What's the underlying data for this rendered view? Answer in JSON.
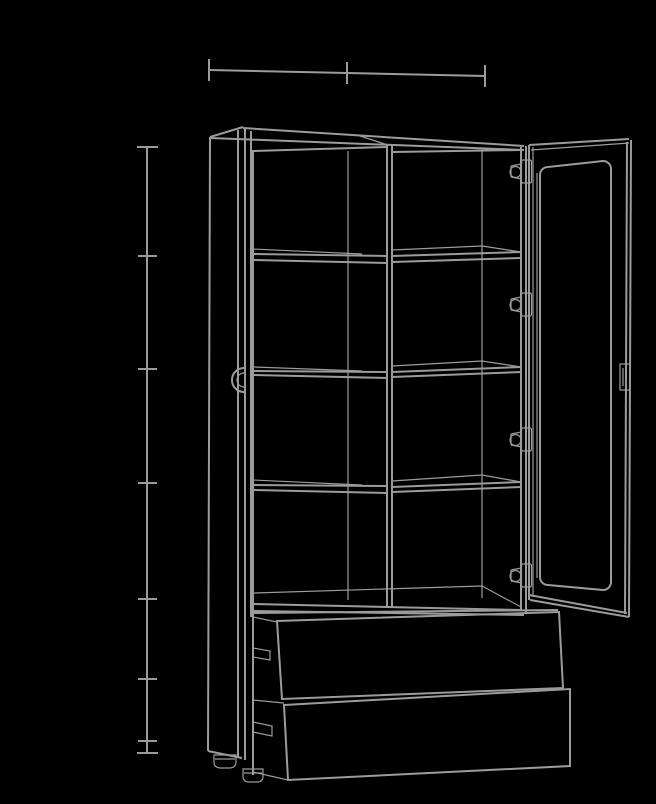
{
  "meta": {
    "label": "Technical line drawing of a tall display cabinet with an open glass door, eight shelf compartments and two patterned drawers",
    "canvas": {
      "width": 656,
      "height": 804
    }
  },
  "style": {
    "background": "#000000",
    "line_color": "#9b9b9b",
    "main_line_width": 2,
    "thin_line_width": 1.2,
    "pattern_line_width": 1.5
  },
  "annotation_guides": {
    "top_width_guide": {
      "axis": "horizontal",
      "y": 73,
      "from_x": 209,
      "to_x": 485,
      "tick_positions_x": [
        209,
        347,
        485
      ],
      "segments": 2
    },
    "left_height_guide": {
      "axis": "vertical",
      "x": 147,
      "from_y": 147,
      "to_y": 753,
      "tick_positions_y": [
        147,
        256,
        369,
        483,
        599,
        679,
        741,
        753
      ],
      "segments": 7
    }
  },
  "furniture": {
    "type": "display cabinet",
    "upper_section": {
      "columns": 2,
      "shelf_rows": 4,
      "movable_shelves": 3,
      "compartments": 8,
      "center_divider": true
    },
    "left_door": {
      "state": "closed",
      "view": "edge-on",
      "handle": "half-round edge pull"
    },
    "right_door": {
      "state": "open",
      "style": "glass frame with rounded inner panel",
      "hinge_count": 4,
      "hinge_y_centers": [
        172,
        305,
        440,
        576
      ],
      "handle": "rectangular edge pull"
    },
    "lower_section": {
      "drawers": 2,
      "front_pattern": "herringbone chevron marquetry",
      "feet": 2
    }
  }
}
